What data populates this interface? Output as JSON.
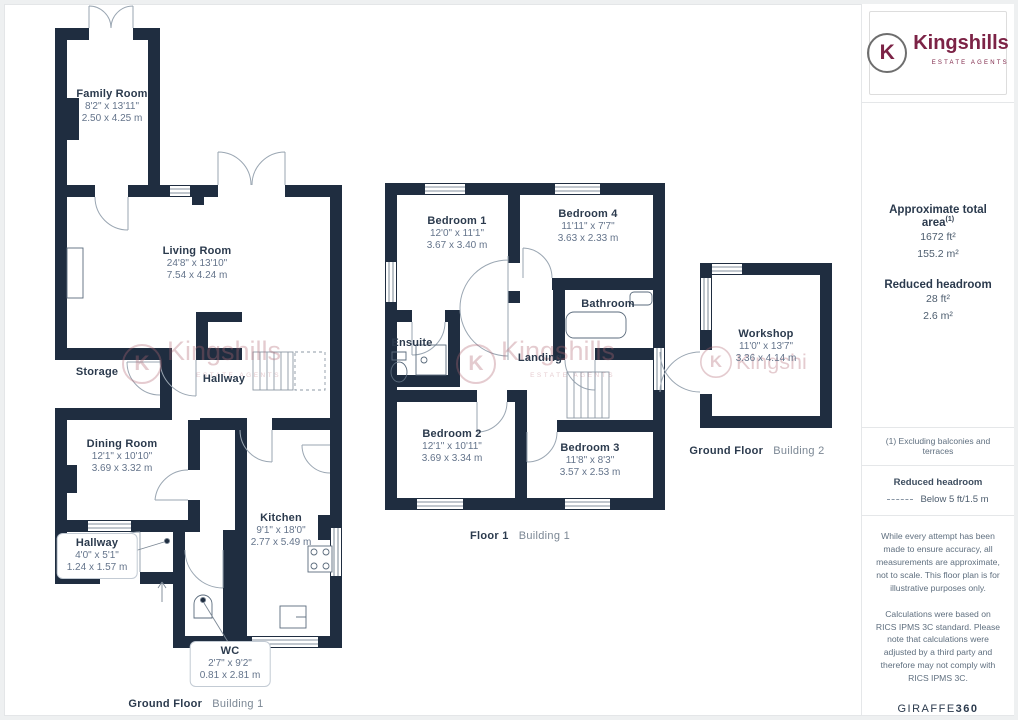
{
  "sidebar": {
    "logo": {
      "letter": "K",
      "name": "Kingshills",
      "tagline": "ESTATE AGENTS"
    },
    "area": {
      "title": "Approximate total area",
      "title_sup": "(1)",
      "ft": "1672 ft²",
      "m": "155.2 m²",
      "rh_title": "Reduced headroom",
      "rh_ft": "28 ft²",
      "rh_m": "2.6 m²"
    },
    "footnote": "(1) Excluding balconies and terraces",
    "legend": {
      "title": "Reduced headroom",
      "value": "Below 5 ft/1.5 m"
    },
    "disclaimer1": "While every attempt has been made to ensure accuracy, all measurements are approximate, not to scale. This floor plan is for illustrative purposes only.",
    "disclaimer2": "Calculations were based on RICS IPMS 3C standard. Please note that calculations were adjusted by a third party and therefore may not comply with RICS IPMS 3C.",
    "credit": {
      "normal": "GIRAFFE",
      "bold": "360"
    }
  },
  "watermark": {
    "letter": "K",
    "name": "Kingshills",
    "tagline": "ESTATE AGENTS"
  },
  "plans": {
    "ground1": {
      "caption_bold": "Ground Floor",
      "caption_light": "Building 1",
      "rooms": {
        "family": {
          "name": "Family Room",
          "ft": "8'2\" x 13'11\"",
          "m": "2.50 x 4.25 m"
        },
        "living": {
          "name": "Living Room",
          "ft": "24'8\" x 13'10\"",
          "m": "7.54 x 4.24 m"
        },
        "storage": {
          "name": "Storage"
        },
        "hallway": {
          "name": "Hallway"
        },
        "dining": {
          "name": "Dining Room",
          "ft": "12'1\" x 10'10\"",
          "m": "3.69 x 3.32 m"
        },
        "hallway2": {
          "name": "Hallway",
          "ft": "4'0\" x 5'1\"",
          "m": "1.24 x 1.57 m"
        },
        "kitchen": {
          "name": "Kitchen",
          "ft": "9'1\" x 18'0\"",
          "m": "2.77 x 5.49 m"
        },
        "wc": {
          "name": "WC",
          "ft": "2'7\" x 9'2\"",
          "m": "0.81 x 2.81 m"
        }
      }
    },
    "floor1": {
      "caption_bold": "Floor 1",
      "caption_light": "Building 1",
      "rooms": {
        "bed1": {
          "name": "Bedroom 1",
          "ft": "12'0\" x 11'1\"",
          "m": "3.67 x 3.40 m"
        },
        "bed4": {
          "name": "Bedroom 4",
          "ft": "11'11\" x 7'7\"",
          "m": "3.63 x 2.33 m"
        },
        "bathroom": {
          "name": "Bathroom"
        },
        "ensuite": {
          "name": "Ensuite"
        },
        "landing": {
          "name": "Landing"
        },
        "bed2": {
          "name": "Bedroom 2",
          "ft": "12'1\" x 10'11\"",
          "m": "3.69 x 3.34 m"
        },
        "bed3": {
          "name": "Bedroom 3",
          "ft": "11'8\" x 8'3\"",
          "m": "3.57 x 2.53 m"
        }
      }
    },
    "ground2": {
      "caption_bold": "Ground Floor",
      "caption_light": "Building 2",
      "rooms": {
        "workshop": {
          "name": "Workshop",
          "ft": "11'0\" x 13'7\"",
          "m": "3.36 x 4.14 m"
        }
      }
    }
  },
  "colors": {
    "wall": "#1f2d40",
    "brand": "#7c2346",
    "room_text": "#2b3a4d",
    "dim_text": "#64748b",
    "watermark": "#b26874"
  }
}
